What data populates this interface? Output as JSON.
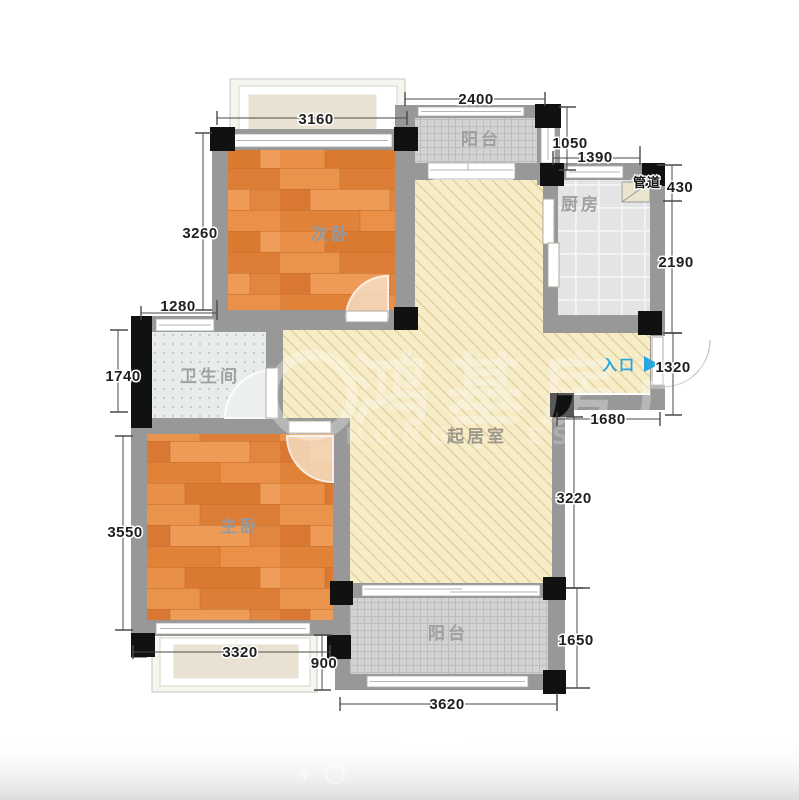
{
  "plan": {
    "rooms": {
      "secondary_bedroom": "次卧",
      "balcony_top": "阳台",
      "kitchen": "厨房",
      "duct": "管道",
      "bathroom": "卫生间",
      "living": "起居室",
      "master_bedroom": "主卧",
      "balcony_bottom": "阳台"
    },
    "entrance": {
      "label": "入口"
    },
    "dims": {
      "d3160": "3160",
      "d2400": "2400",
      "d1050": "1050",
      "d1390": "1390",
      "d430": "430",
      "d2190": "2190",
      "d3260": "3260",
      "d1280": "1280",
      "d1740": "1740",
      "d1320": "1320",
      "d1680": "1680",
      "d3220": "3220",
      "d3550": "3550",
      "d3320": "3320",
      "d900": "900",
      "d1650": "1650",
      "d3620": "3620"
    },
    "watermark": {
      "text": "鸿基房产",
      "subtext": "HONG JI ESTATE"
    },
    "colors": {
      "entry_blue": "#2ba6de",
      "wood_orange": "#e28840",
      "living_cream": "#f6ecc6",
      "wall_gray": "#989898",
      "balcony_tile": "#d3d1d2",
      "kitchen_tile": "#e4e4e7",
      "bathroom_tile": "#e8edec"
    }
  }
}
